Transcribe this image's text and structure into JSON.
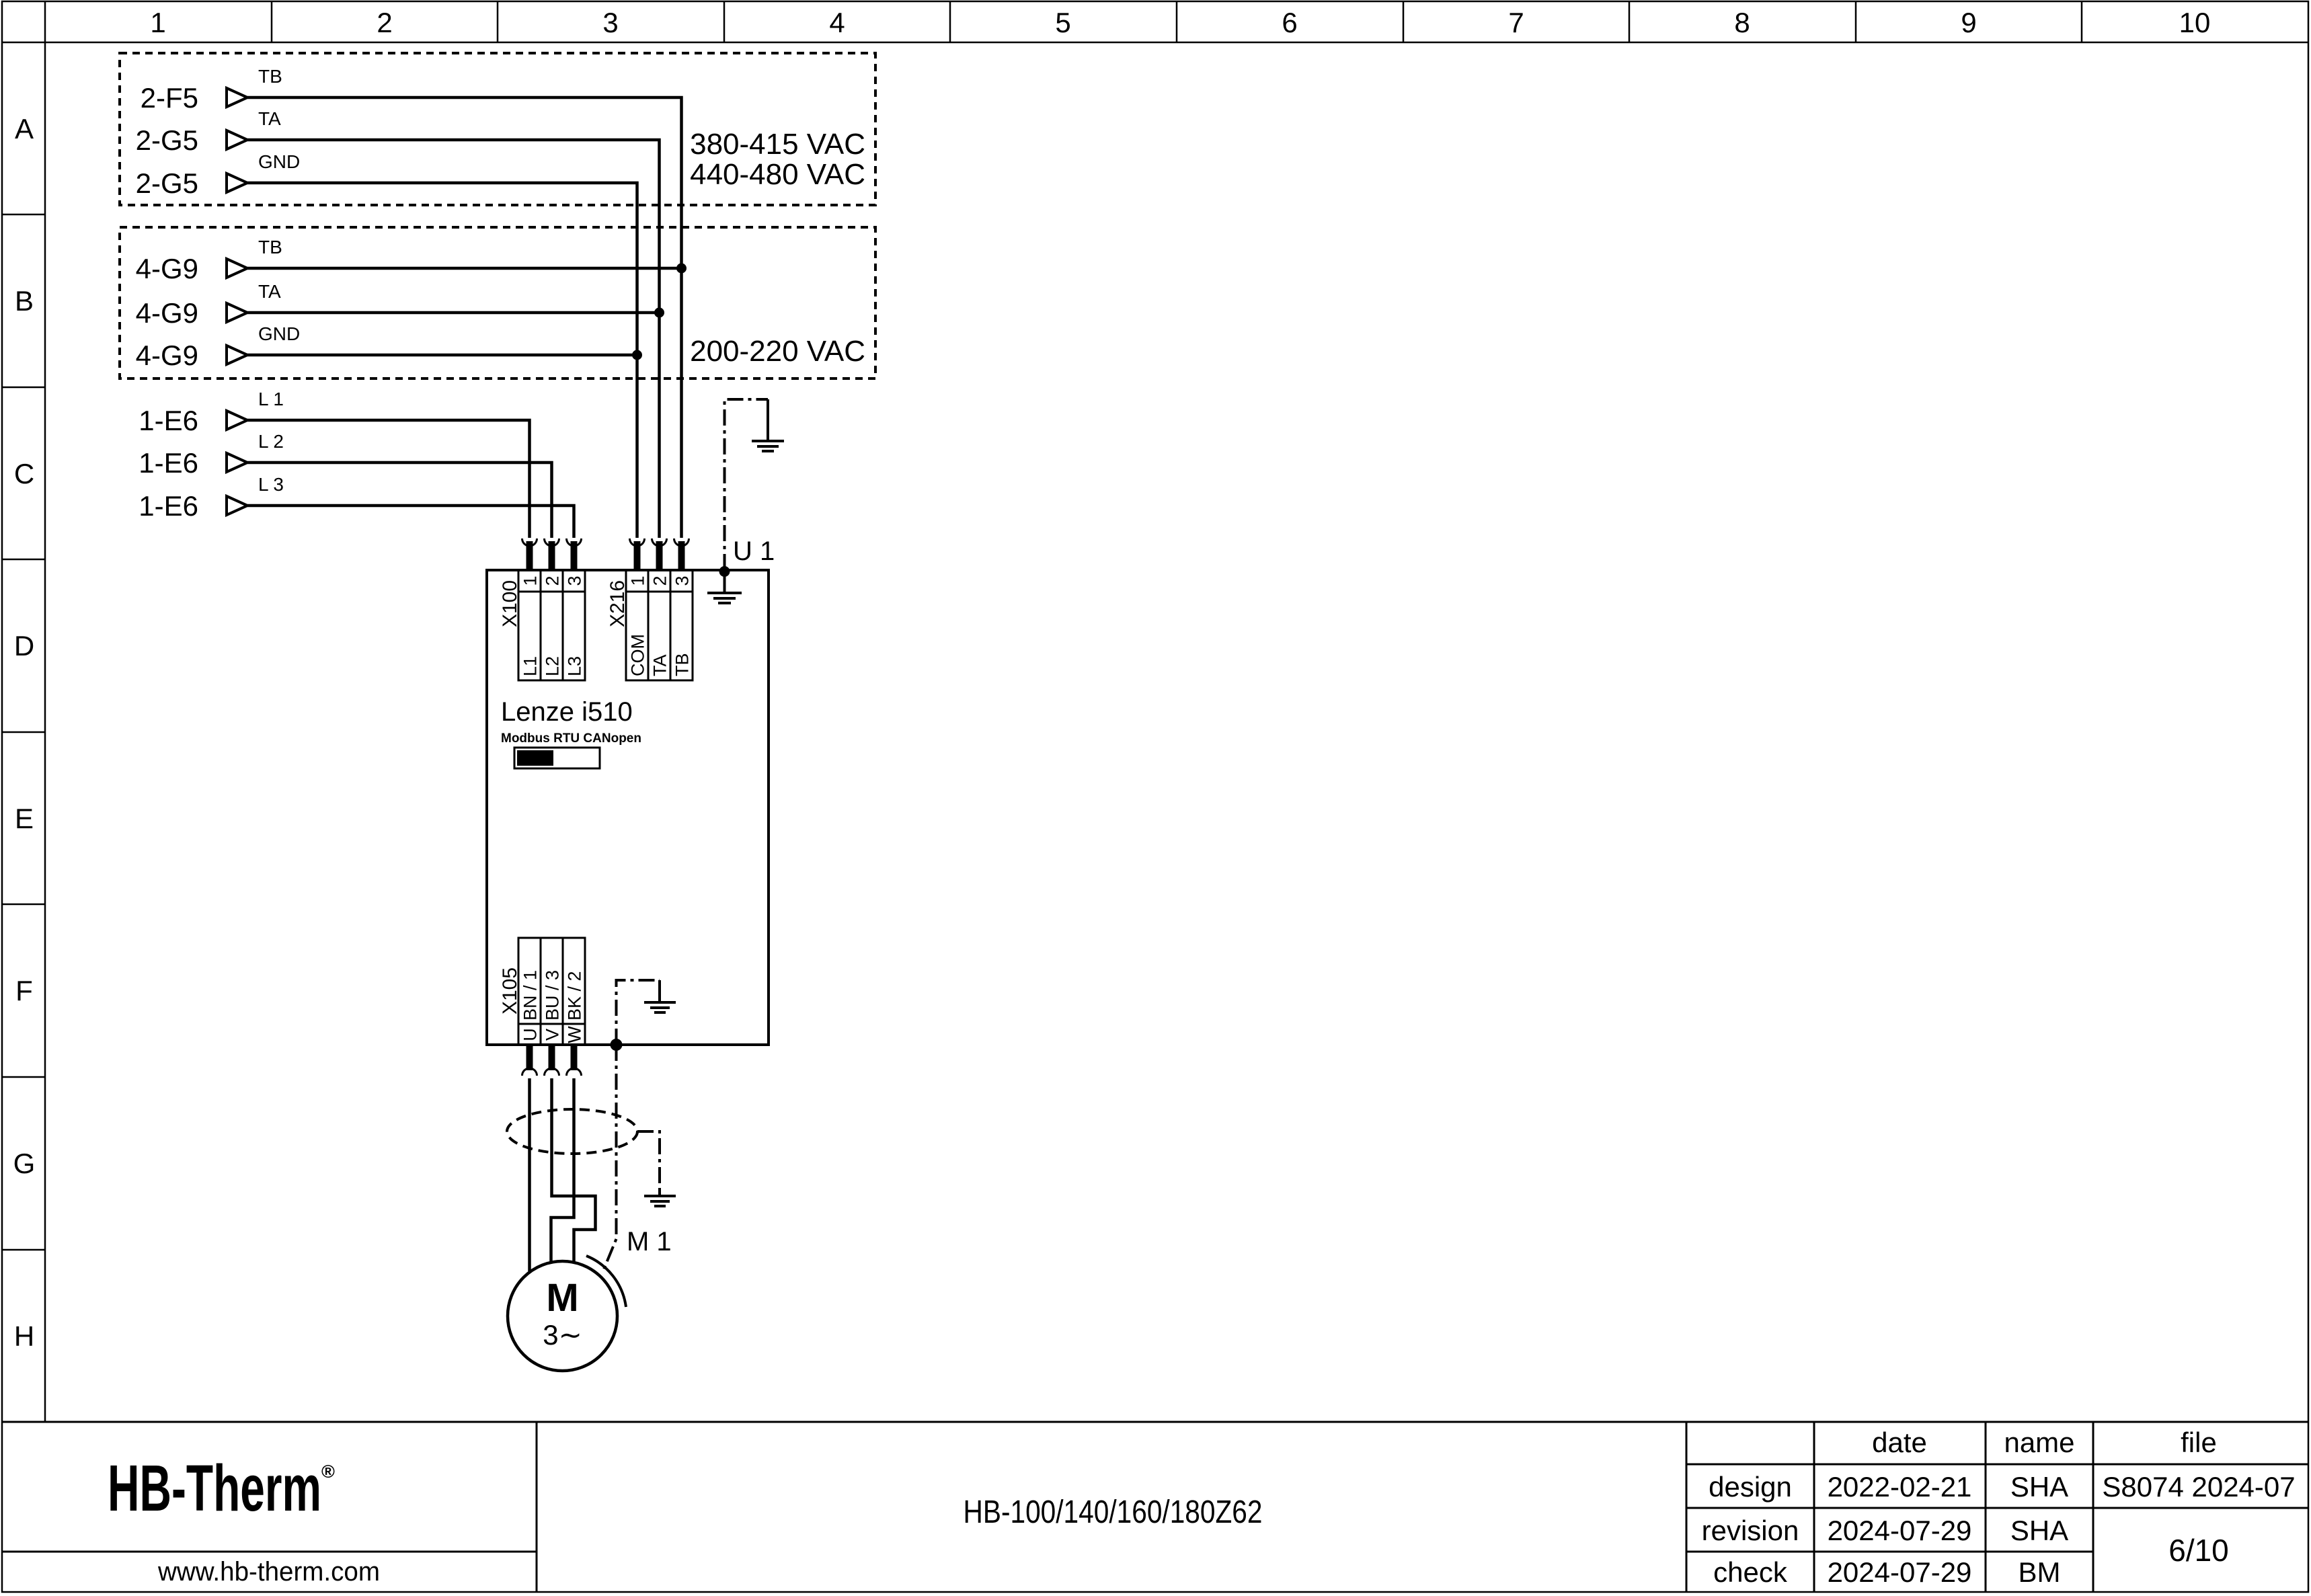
{
  "frame": {
    "columns": [
      "1",
      "2",
      "3",
      "4",
      "5",
      "6",
      "7",
      "8",
      "9",
      "10"
    ],
    "rows": [
      "A",
      "B",
      "C",
      "D",
      "E",
      "F",
      "G",
      "H"
    ]
  },
  "sources": {
    "group_a": {
      "refs": [
        "2-F5",
        "2-G5",
        "2-G5"
      ],
      "signals": [
        "TB",
        "TA",
        "GND"
      ],
      "voltage_1": "380-415 VAC",
      "voltage_2": "440-480 VAC"
    },
    "group_b": {
      "refs": [
        "4-G9",
        "4-G9",
        "4-G9"
      ],
      "signals": [
        "TB",
        "TA",
        "GND"
      ],
      "voltage_1": "200-220 VAC"
    },
    "group_c": {
      "refs": [
        "1-E6",
        "1-E6",
        "1-E6"
      ],
      "signals": [
        "L 1",
        "L 2",
        "L 3"
      ]
    }
  },
  "drive": {
    "designator": "U 1",
    "model": "Lenze i510",
    "fieldbus": "Modbus RTU CANopen",
    "x100": {
      "name": "X100",
      "pins": [
        "1",
        "2",
        "3"
      ],
      "labels": [
        "L1",
        "L2",
        "L3"
      ]
    },
    "x216": {
      "name": "X216",
      "pins": [
        "1",
        "2",
        "3"
      ],
      "labels": [
        "COM",
        "TA",
        "TB"
      ]
    },
    "x105": {
      "name": "X105",
      "pins": [
        "U",
        "V",
        "W"
      ],
      "labels": [
        "BN / 1",
        "BU / 3",
        "BK / 2"
      ]
    }
  },
  "motor": {
    "designator": "M 1",
    "symbol": "M",
    "phase": "3∼"
  },
  "title_block": {
    "logo_text": "HB-Therm",
    "logo_mark": "®",
    "website": "www.hb-therm.com",
    "product": "HB-100/140/160/180Z62",
    "col_date": "date",
    "col_name": "name",
    "col_file": "file",
    "row_design": {
      "label": "design",
      "date": "2022-02-21",
      "name": "SHA"
    },
    "row_revision": {
      "label": "revision",
      "date": "2024-07-29",
      "name": "SHA"
    },
    "row_check": {
      "label": "check",
      "date": "2024-07-29",
      "name": "BM"
    },
    "file_value": "S8074 2024-07",
    "page": "6/10"
  },
  "colors": {
    "ink": "#000000",
    "logo": "#1e2a47",
    "paper": "#ffffff"
  }
}
